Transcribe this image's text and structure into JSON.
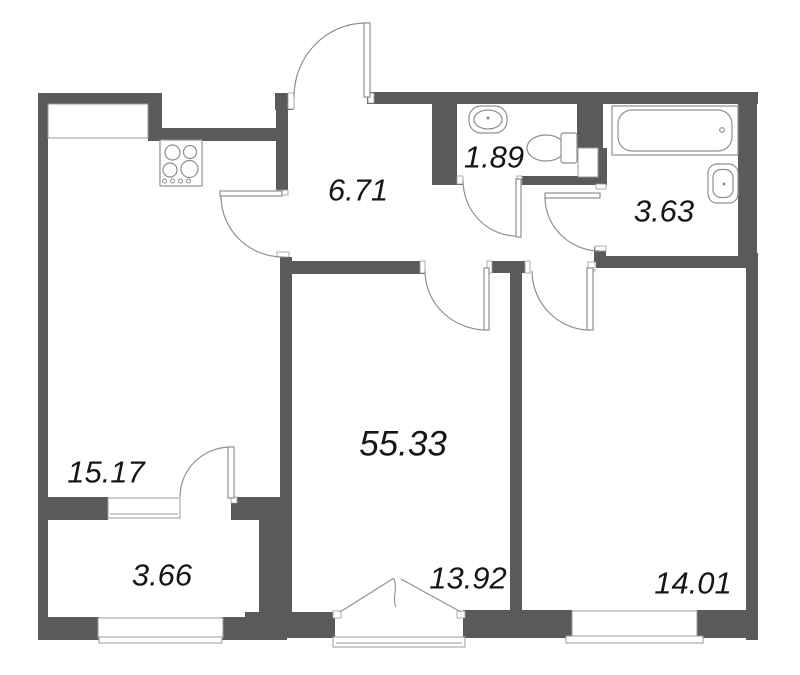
{
  "plan": {
    "total_area": "55.33",
    "rooms": {
      "hallway": {
        "area": "6.71"
      },
      "wc": {
        "area": "1.89"
      },
      "bathroom": {
        "area": "3.63"
      },
      "kitchen_living": {
        "area": "15.17"
      },
      "balcony": {
        "area": "3.66"
      },
      "living_room": {
        "area": "13.92"
      },
      "bedroom": {
        "area": "14.01"
      }
    },
    "fixtures": [
      "stove-icon",
      "sink-icon",
      "toilet-icon",
      "bathtub-icon",
      "sink-icon"
    ],
    "colors": {
      "wall": "#5a5a5a",
      "thin_line": "#8f8f8f",
      "window_line": "#9a9a9a",
      "text": "#161616",
      "background": "#ffffff"
    }
  }
}
